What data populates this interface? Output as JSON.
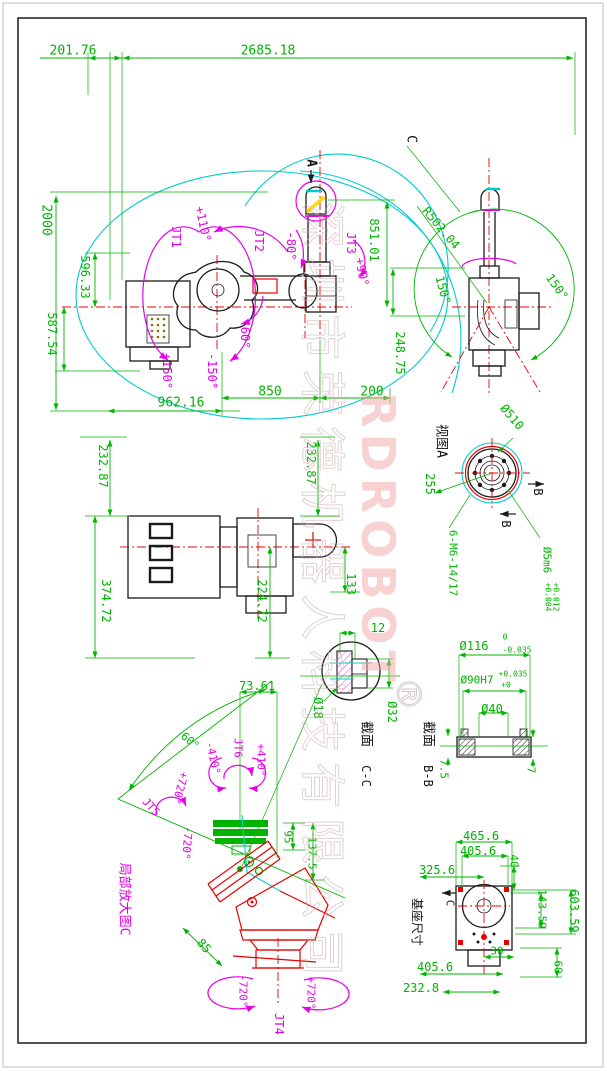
{
  "drawing": {
    "type": "robot-arm-dimension-drawing",
    "sheet_border_color": "#1a1a1a",
    "colors": {
      "dimension": "#00b400",
      "joint": "#e800e8",
      "envelope": "#00cccc",
      "centerline": "#e80000",
      "outline": "#1a1a1a",
      "watermark_cn": "#c9aeae",
      "watermark_en": "#f0a0a0",
      "highlight": "#ffd700"
    },
    "joints": [
      {
        "name": "JT1",
        "limits": [
          "+150°",
          "-150°"
        ]
      },
      {
        "name": "JT2",
        "limits": [
          "+110°",
          "-60°"
        ]
      },
      {
        "name": "JT3",
        "limits": [
          "+90°",
          "-80°"
        ]
      },
      {
        "name": "JT4",
        "limits": [
          "+720°",
          "-720°"
        ]
      },
      {
        "name": "JT5",
        "limits": [
          "+720°",
          "-720°"
        ]
      },
      {
        "name": "JT6",
        "limits": [
          "+410°",
          "-410°"
        ]
      }
    ]
  },
  "watermark": {
    "company_cn": "深圳市荣德机器人科技有限公司",
    "brand_en": "RDROBOT",
    "registered": "®"
  },
  "view_titles": {
    "view_a": "视图A",
    "section_cc": "截面 C-C",
    "section_bb": "截面 B-B",
    "enlarged_c": "局部放大图C",
    "base": "基座尺寸"
  },
  "annotations": [
    {
      "n": "dim-201-76",
      "t": "201.76",
      "x": 73,
      "y": 51,
      "r": 0,
      "c": "g",
      "s": 13
    },
    {
      "n": "dim-2685-18",
      "t": "2685.18",
      "x": 268,
      "y": 51,
      "r": 0,
      "c": "g",
      "s": 13
    },
    {
      "n": "dim-2000",
      "t": "2000",
      "x": 46,
      "y": 220,
      "r": 90,
      "c": "g",
      "s": 13
    },
    {
      "n": "dim-596-33",
      "t": "596.33",
      "x": 85,
      "y": 277,
      "r": 90,
      "c": "g",
      "s": 12
    },
    {
      "n": "dim-587-54",
      "t": "587.54",
      "x": 52,
      "y": 334,
      "r": 90,
      "c": "g",
      "s": 12
    },
    {
      "n": "dim-962-16",
      "t": "962.16",
      "x": 181,
      "y": 403,
      "r": 0,
      "c": "g",
      "s": 13
    },
    {
      "n": "dim-850",
      "t": "850",
      "x": 270,
      "y": 392,
      "r": 0,
      "c": "g",
      "s": 13
    },
    {
      "n": "dim-200",
      "t": "200",
      "x": 372,
      "y": 392,
      "r": 0,
      "c": "g",
      "s": 13
    },
    {
      "n": "dim-851-01",
      "t": "851.01",
      "x": 374,
      "y": 240,
      "r": 90,
      "c": "g",
      "s": 12
    },
    {
      "n": "dim-248-75",
      "t": "248.75",
      "x": 400,
      "y": 353,
      "r": 90,
      "c": "g",
      "s": 12
    },
    {
      "n": "joint-jt1",
      "t": "JT1",
      "x": 176,
      "y": 237,
      "r": 90,
      "c": "m",
      "s": 12
    },
    {
      "n": "angle-plus110",
      "t": "+110°",
      "x": 203,
      "y": 224,
      "r": 78,
      "c": "m",
      "s": 12
    },
    {
      "n": "joint-jt2",
      "t": "JT2",
      "x": 259,
      "y": 241,
      "r": 90,
      "c": "m",
      "s": 12
    },
    {
      "n": "angle-minus80",
      "t": "-80°",
      "x": 291,
      "y": 246,
      "r": 90,
      "c": "m",
      "s": 12
    },
    {
      "n": "joint-jt3",
      "t": "JT3",
      "x": 351,
      "y": 243,
      "r": 90,
      "c": "m",
      "s": 12
    },
    {
      "n": "angle-plus90",
      "t": "+90°",
      "x": 362,
      "y": 272,
      "r": 80,
      "c": "m",
      "s": 12
    },
    {
      "n": "angle-minus60",
      "t": "-60°",
      "x": 245,
      "y": 334,
      "r": 90,
      "c": "m",
      "s": 12
    },
    {
      "n": "angle-plus150",
      "t": "+150°",
      "x": 167,
      "y": 371,
      "r": 90,
      "c": "m",
      "s": 12
    },
    {
      "n": "angle-minus150",
      "t": "-150°",
      "x": 212,
      "y": 371,
      "r": 90,
      "c": "m",
      "s": 12
    },
    {
      "n": "label-view-arrow-a",
      "t": "A",
      "x": 311,
      "y": 163,
      "r": 90,
      "c": "k",
      "s": 13,
      "fw": "bold"
    },
    {
      "n": "label-c-top",
      "t": "C",
      "x": 411,
      "y": 139,
      "r": 90,
      "c": "k",
      "s": 13
    },
    {
      "n": "dim-r502-04",
      "t": "R502.04",
      "x": 441,
      "y": 228,
      "r": 50,
      "c": "g",
      "s": 12
    },
    {
      "n": "angle-150-right",
      "t": "150°",
      "x": 557,
      "y": 287,
      "r": 55,
      "c": "g",
      "s": 12
    },
    {
      "n": "angle-150-left",
      "t": "150°",
      "x": 443,
      "y": 290,
      "r": 75,
      "c": "g",
      "s": 12
    },
    {
      "n": "label-view-a",
      "t": "视图A",
      "x": 441,
      "y": 441,
      "r": 90,
      "c": "k",
      "s": 13
    },
    {
      "n": "dim-dia510",
      "t": "Ø510",
      "x": 512,
      "y": 417,
      "r": 50,
      "c": "g",
      "s": 12
    },
    {
      "n": "dim-255",
      "t": "255",
      "x": 430,
      "y": 484,
      "r": 90,
      "c": "g",
      "s": 12
    },
    {
      "n": "label-b1",
      "t": "B",
      "x": 538,
      "y": 492,
      "r": 90,
      "c": "k",
      "s": 12
    },
    {
      "n": "label-b2",
      "t": "B",
      "x": 506,
      "y": 524,
      "r": 90,
      "c": "k",
      "s": 12
    },
    {
      "n": "dim-6-m6",
      "t": "6-M6-14/17",
      "x": 453,
      "y": 563,
      "r": 90,
      "c": "g",
      "s": 11
    },
    {
      "n": "dim-dia5m6",
      "t": "Ø5m6",
      "x": 547,
      "y": 560,
      "r": 90,
      "c": "g",
      "s": 11
    },
    {
      "n": "tol-5m6-up",
      "t": "+0.012",
      "x": 556,
      "y": 597,
      "r": 90,
      "c": "g",
      "s": 8
    },
    {
      "n": "tol-5m6-lo",
      "t": "+0.004",
      "x": 548,
      "y": 597,
      "r": 90,
      "c": "g",
      "s": 8
    },
    {
      "n": "dim-232-87-left",
      "t": "232.87",
      "x": 103,
      "y": 466,
      "r": 90,
      "c": "g",
      "s": 12
    },
    {
      "n": "dim-374-72",
      "t": "374.72",
      "x": 106,
      "y": 601,
      "r": 90,
      "c": "g",
      "s": 12
    },
    {
      "n": "dim-224-72",
      "t": "224.72",
      "x": 262,
      "y": 601,
      "r": 90,
      "c": "g",
      "s": 12
    },
    {
      "n": "dim-133",
      "t": "133",
      "x": 351,
      "y": 584,
      "r": 90,
      "c": "g",
      "s": 12
    },
    {
      "n": "dim-232-87-right",
      "t": "232.87",
      "x": 311,
      "y": 463,
      "r": 90,
      "c": "g",
      "s": 12
    },
    {
      "n": "dim-12",
      "t": "12",
      "x": 378,
      "y": 628,
      "r": 0,
      "c": "g",
      "s": 12
    },
    {
      "n": "dim-dia18",
      "t": "Ø18",
      "x": 318,
      "y": 708,
      "r": 90,
      "c": "g",
      "s": 12
    },
    {
      "n": "dim-dia32",
      "t": "Ø32",
      "x": 392,
      "y": 712,
      "r": 90,
      "c": "g",
      "s": 12
    },
    {
      "n": "label-section-cc-1",
      "t": "截面",
      "x": 366,
      "y": 734,
      "r": 90,
      "c": "k",
      "s": 13
    },
    {
      "n": "label-section-cc-2",
      "t": "C-C",
      "x": 366,
      "y": 776,
      "r": 90,
      "c": "k",
      "s": 12
    },
    {
      "n": "label-section-bb-1",
      "t": "截面",
      "x": 428,
      "y": 734,
      "r": 90,
      "c": "k",
      "s": 13
    },
    {
      "n": "label-section-bb-2",
      "t": "B-B",
      "x": 428,
      "y": 776,
      "r": 90,
      "c": "k",
      "s": 12
    },
    {
      "n": "dim-dia116",
      "t": "Ø116",
      "x": 474,
      "y": 646,
      "r": 0,
      "c": "g",
      "s": 12
    },
    {
      "n": "tol-116-up",
      "t": "0",
      "x": 505,
      "y": 637,
      "r": 0,
      "c": "g",
      "s": 8
    },
    {
      "n": "tol-116-lo",
      "t": "-0.035",
      "x": 517,
      "y": 650,
      "r": 0,
      "c": "g",
      "s": 8
    },
    {
      "n": "dim-dia90h7",
      "t": "Ø90H7",
      "x": 477,
      "y": 680,
      "r": 0,
      "c": "g",
      "s": 11
    },
    {
      "n": "tol-90-up",
      "t": "+0.035",
      "x": 513,
      "y": 674,
      "r": 0,
      "c": "g",
      "s": 8
    },
    {
      "n": "tol-90-lo",
      "t": "+0",
      "x": 506,
      "y": 685,
      "r": 0,
      "c": "g",
      "s": 8
    },
    {
      "n": "dim-dia40",
      "t": "Ø40",
      "x": 492,
      "y": 709,
      "r": 0,
      "c": "g",
      "s": 12
    },
    {
      "n": "dim-7-5",
      "t": "7.5",
      "x": 444,
      "y": 769,
      "r": 90,
      "c": "g",
      "s": 11
    },
    {
      "n": "dim-7",
      "t": "7",
      "x": 531,
      "y": 770,
      "r": 90,
      "c": "g",
      "s": 11
    },
    {
      "n": "dim-73-61",
      "t": "73.61",
      "x": 257,
      "y": 686,
      "r": 0,
      "c": "g",
      "s": 12
    },
    {
      "n": "angle-60",
      "t": "60°",
      "x": 190,
      "y": 741,
      "r": 40,
      "c": "g",
      "s": 11
    },
    {
      "n": "joint-jt6",
      "t": "JT6",
      "x": 238,
      "y": 748,
      "r": 90,
      "c": "m",
      "s": 11
    },
    {
      "n": "angle-minus410",
      "t": "-410°",
      "x": 213,
      "y": 758,
      "r": 78,
      "c": "m",
      "s": 11
    },
    {
      "n": "angle-plus410",
      "t": "+410°",
      "x": 261,
      "y": 760,
      "r": 90,
      "c": "m",
      "s": 11
    },
    {
      "n": "angle-plus720-jt5",
      "t": "+720°",
      "x": 180,
      "y": 788,
      "r": 105,
      "c": "m",
      "s": 11
    },
    {
      "n": "joint-jt5",
      "t": "JT5",
      "x": 151,
      "y": 807,
      "r": 48,
      "c": "m",
      "s": 11
    },
    {
      "n": "angle-minus720-jt5",
      "t": "-720°",
      "x": 187,
      "y": 843,
      "r": 95,
      "c": "m",
      "s": 11
    },
    {
      "n": "dim-95",
      "t": "95",
      "x": 288,
      "y": 837,
      "r": 90,
      "c": "g",
      "s": 11
    },
    {
      "n": "dim-137-5",
      "t": "137.5",
      "x": 312,
      "y": 853,
      "r": 90,
      "c": "g",
      "s": 11
    },
    {
      "n": "label-enlarged-c",
      "t": "局部放大图C",
      "x": 124,
      "y": 899,
      "r": 90,
      "c": "m",
      "s": 13
    },
    {
      "n": "dim-85",
      "t": "85",
      "x": 204,
      "y": 946,
      "r": 48,
      "c": "g",
      "s": 12
    },
    {
      "n": "angle-minus720-jt4",
      "t": "-720°",
      "x": 243,
      "y": 991,
      "r": 90,
      "c": "m",
      "s": 11
    },
    {
      "n": "angle-plus720-jt4",
      "t": "+720°",
      "x": 311,
      "y": 993,
      "r": 90,
      "c": "m",
      "s": 11
    },
    {
      "n": "joint-jt4",
      "t": "JT4",
      "x": 279,
      "y": 1024,
      "r": 90,
      "c": "m",
      "s": 12
    },
    {
      "n": "dim-465-6",
      "t": "465.6",
      "x": 481,
      "y": 836,
      "r": 0,
      "c": "g",
      "s": 12
    },
    {
      "n": "dim-405-6a",
      "t": "405.6",
      "x": 478,
      "y": 851,
      "r": 0,
      "c": "g",
      "s": 12
    },
    {
      "n": "dim-40",
      "t": "40",
      "x": 514,
      "y": 861,
      "r": 90,
      "c": "g",
      "s": 11
    },
    {
      "n": "dim-325-6",
      "t": "325.6",
      "x": 437,
      "y": 870,
      "r": 0,
      "c": "g",
      "s": 12
    },
    {
      "n": "dim-143-59",
      "t": "143.59",
      "x": 542,
      "y": 909,
      "r": 90,
      "c": "g",
      "s": 11
    },
    {
      "n": "dim-603-59",
      "t": "603.59",
      "x": 574,
      "y": 911,
      "r": 90,
      "c": "g",
      "s": 12
    },
    {
      "n": "dim-30",
      "t": "30",
      "x": 497,
      "y": 951,
      "r": 0,
      "c": "g",
      "s": 11
    },
    {
      "n": "dim-60",
      "t": "60",
      "x": 558,
      "y": 967,
      "r": 90,
      "c": "g",
      "s": 11
    },
    {
      "n": "dim-405-6b",
      "t": "405.6",
      "x": 435,
      "y": 967,
      "r": 0,
      "c": "g",
      "s": 12
    },
    {
      "n": "dim-232-8",
      "t": "232.8",
      "x": 421,
      "y": 988,
      "r": 0,
      "c": "g",
      "s": 12
    },
    {
      "n": "label-base-size",
      "t": "基座尺寸",
      "x": 417,
      "y": 922,
      "r": 90,
      "c": "k",
      "s": 12
    },
    {
      "n": "label-c-base",
      "t": "C",
      "x": 450,
      "y": 903,
      "r": 90,
      "c": "k",
      "s": 11
    },
    {
      "n": "watermark-cn",
      "t": "深圳市荣德机器人科技有限公司",
      "x": 322,
      "y": 594,
      "r": 90,
      "c": "w1",
      "s": 46,
      "ls": 10,
      "o": 0.55,
      "wm": 1,
      "hollow": 1
    },
    {
      "n": "watermark-en",
      "t": "RDROBOT",
      "x": 378,
      "y": 540,
      "r": 90,
      "c": "w2",
      "s": 46,
      "ls": 6,
      "o": 0.5,
      "fw": "bold",
      "wm": 1
    },
    {
      "n": "watermark-reg",
      "t": "®",
      "x": 408,
      "y": 694,
      "r": 90,
      "c": "w3",
      "s": 34,
      "o": 0.6,
      "wm": 1,
      "hollow": 1
    }
  ]
}
